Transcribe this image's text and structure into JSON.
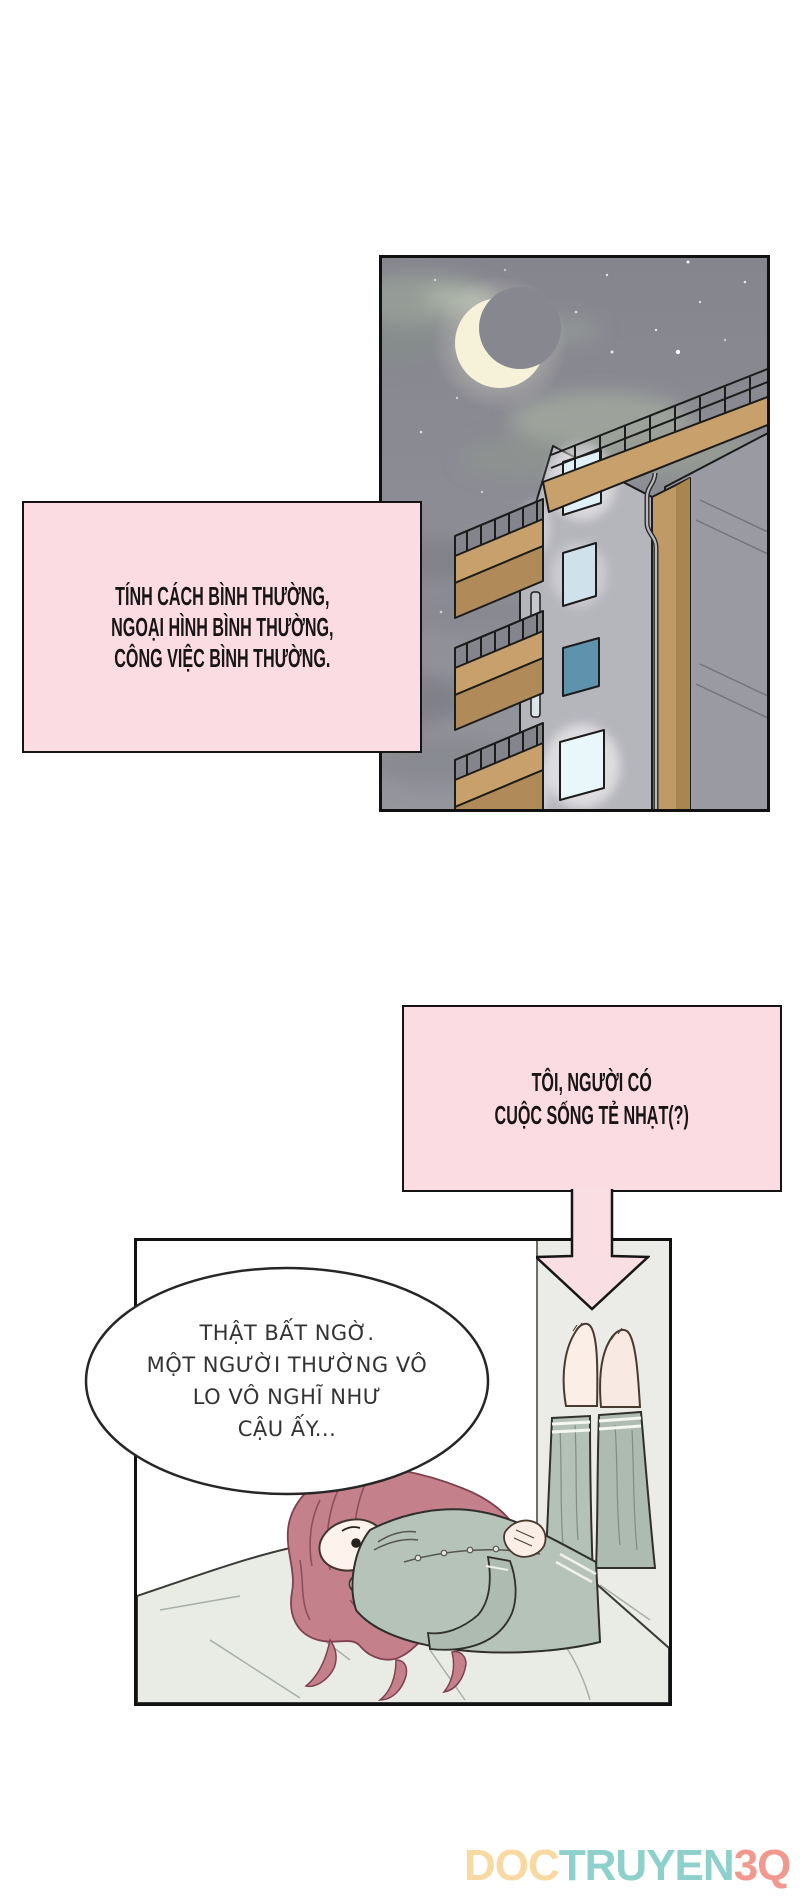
{
  "page": {
    "width": 800,
    "height": 1896,
    "background": "#ffffff"
  },
  "colors": {
    "panel_border": "#111111",
    "caption_pink": "#fbdce3",
    "arrow_pink": "#f9dee4",
    "night_sky": "#8d8d95",
    "moon": "#f6f2da",
    "building_tan": "#c7a06c",
    "building_gray": "#b5b5bc",
    "lit_window": "#dff0f7",
    "teal_window": "#5e92ad",
    "bedroom_wall": "#ebece7",
    "bed_sheet": "#e9ece5",
    "pants_green": "#b1beb3",
    "jacket_green": "#b6c3b9",
    "hair_pink": "#c4818c",
    "skin": "#fdf2ec",
    "caption_text": "#181516",
    "bubble_text": "#333333"
  },
  "caption_box": {
    "lines": [
      "TÍNH CÁCH BÌNH THƯỜNG,",
      "NGOẠI HÌNH BÌNH THƯỜNG,",
      "CÔNG VIỆC BÌNH THƯỜNG."
    ]
  },
  "thought_box": {
    "lines": [
      "TÔI, NGƯỜI CÓ",
      "CUỘC SỐNG TẺ NHẠT(?)"
    ]
  },
  "speech_bubble": {
    "lines": [
      "THẬT BẤT NGỜ.",
      "MỘT NGƯỜI THƯỜNG VÔ",
      "LO VÔ NGHĨ NHƯ",
      "CẬU ẤY..."
    ]
  },
  "watermark": {
    "segments": [
      {
        "text": "DOC",
        "color": "#f8d9a1"
      },
      {
        "text": "TRUYEN",
        "color": "#8ed0cc"
      },
      {
        "text": "3Q",
        "color": "#f2998f"
      }
    ]
  },
  "scene": {
    "night_panel": "crescent moon, stars and clouds over an apartment building with lit windows",
    "bedroom_panel": "person lying on a bed with legs up against the wall"
  }
}
